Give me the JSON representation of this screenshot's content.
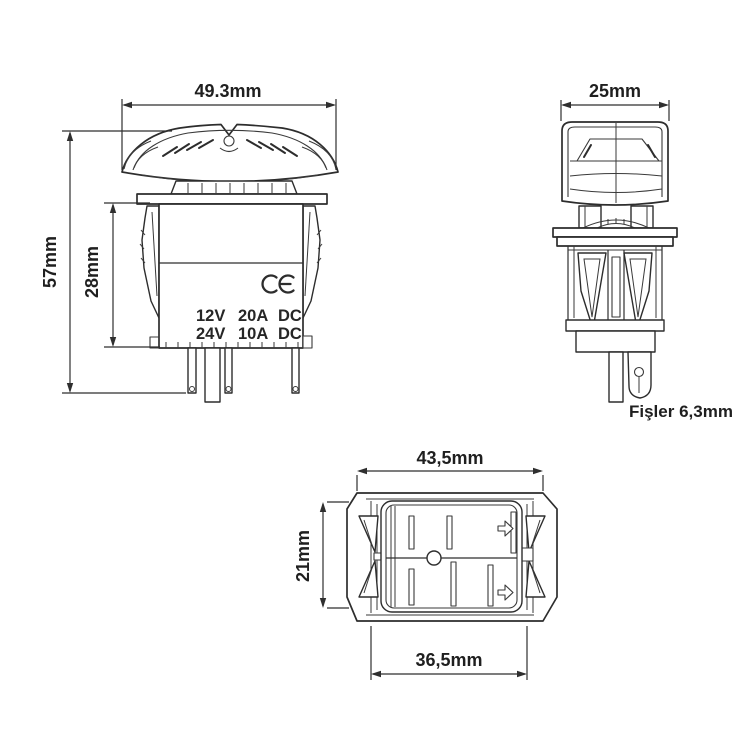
{
  "page": {
    "background_color": "#ffffff",
    "line_color": "#2d2d2d",
    "text_color": "#1f1f1f"
  },
  "drawing": {
    "kind": "rocker-switch-dimensional-drawing",
    "front": {
      "width_dim": "49.3mm",
      "height_dim": "57mm",
      "body_height_dim": "28mm",
      "ce_mark": "CE",
      "rating": {
        "r1c1": "12V",
        "r1c2": "20A",
        "r1c3": "DC",
        "r2c1": "24V",
        "r2c2": "10A",
        "r2c3": "DC"
      }
    },
    "side": {
      "width_dim": "25mm",
      "terminal_note": "Fişler 6,3mm"
    },
    "bottom": {
      "width_dim": "43,5mm",
      "height_dim": "21mm",
      "cutout_width_dim": "36,5mm"
    }
  }
}
